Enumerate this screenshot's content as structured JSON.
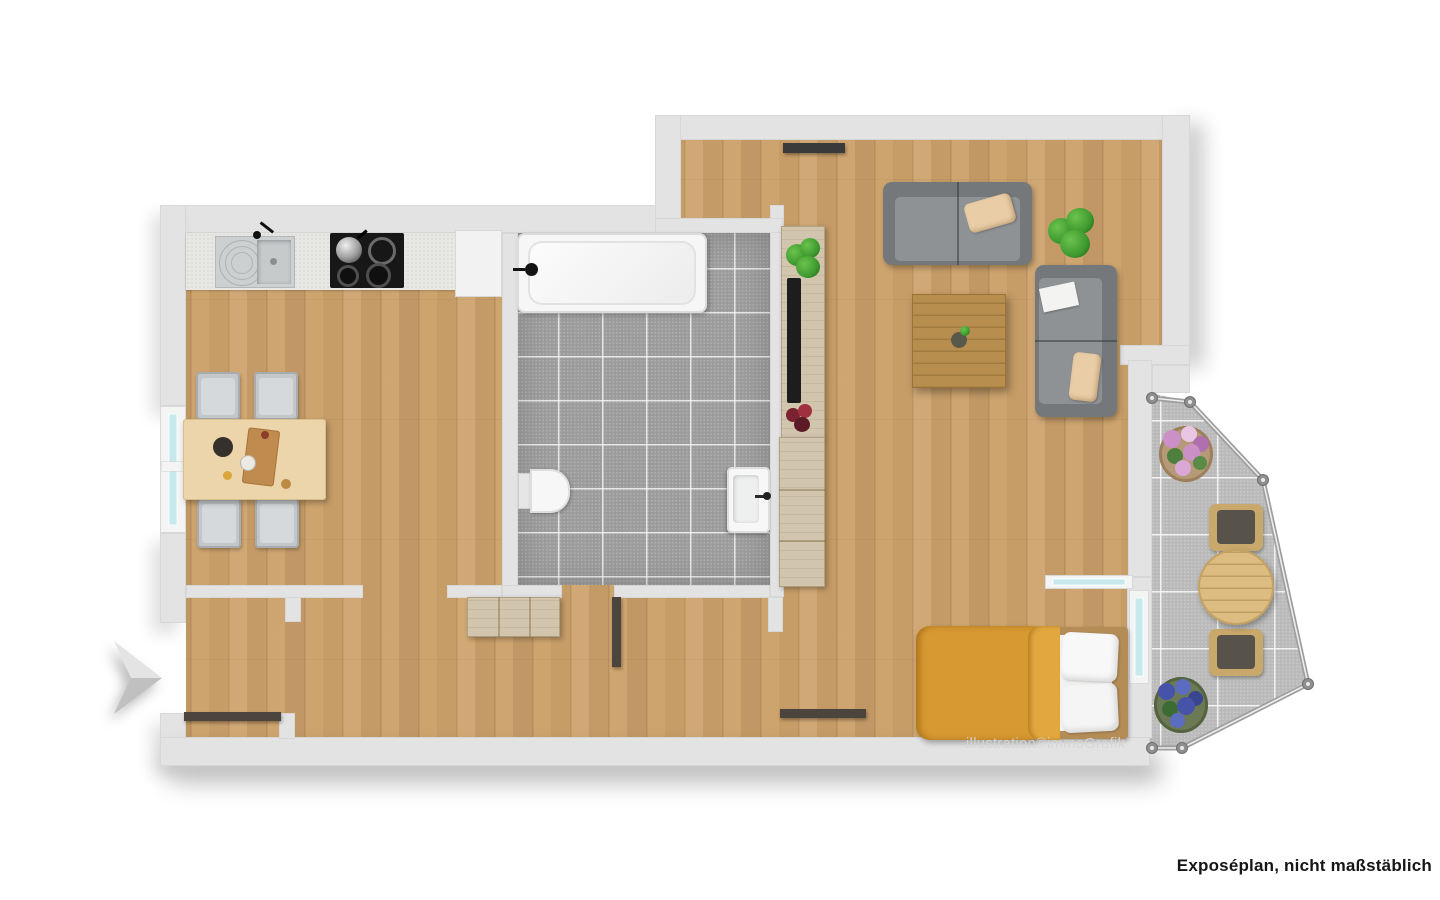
{
  "texts": {
    "watermark": "illustration©immoGrafik",
    "footer_label": "Exposéplan, nicht maßstäblich"
  },
  "colors": {
    "wall": "#e3e3e4",
    "wood": "#cda26b",
    "bath_tile": "#9c9c9c",
    "balcony_tile": "#bababa",
    "sofa": "#8e9295",
    "sofa_dark": "#74787b",
    "pillow": "#e9cda6",
    "bed_orange": "#d79932",
    "bed_orange_2": "#e2a83f",
    "door": "#4b453d",
    "glass": "#c8e9ec",
    "counter": "#e7e7e4",
    "steel": "#ccd0d1",
    "cooktop": "#171717",
    "table_wood": "#ecd4ab",
    "coffee_wood": "#b78e4d",
    "unit_wood": "#d2c5ad",
    "head_wood": "#b38c56",
    "plant": "#3e9a2f",
    "flower_pink": "#cb90c5",
    "flower_blue": "#4653a8",
    "railing": "#a2a2a2",
    "chair_gray": "#c4c7ca",
    "fixture_white": "#f6f6f6"
  }
}
